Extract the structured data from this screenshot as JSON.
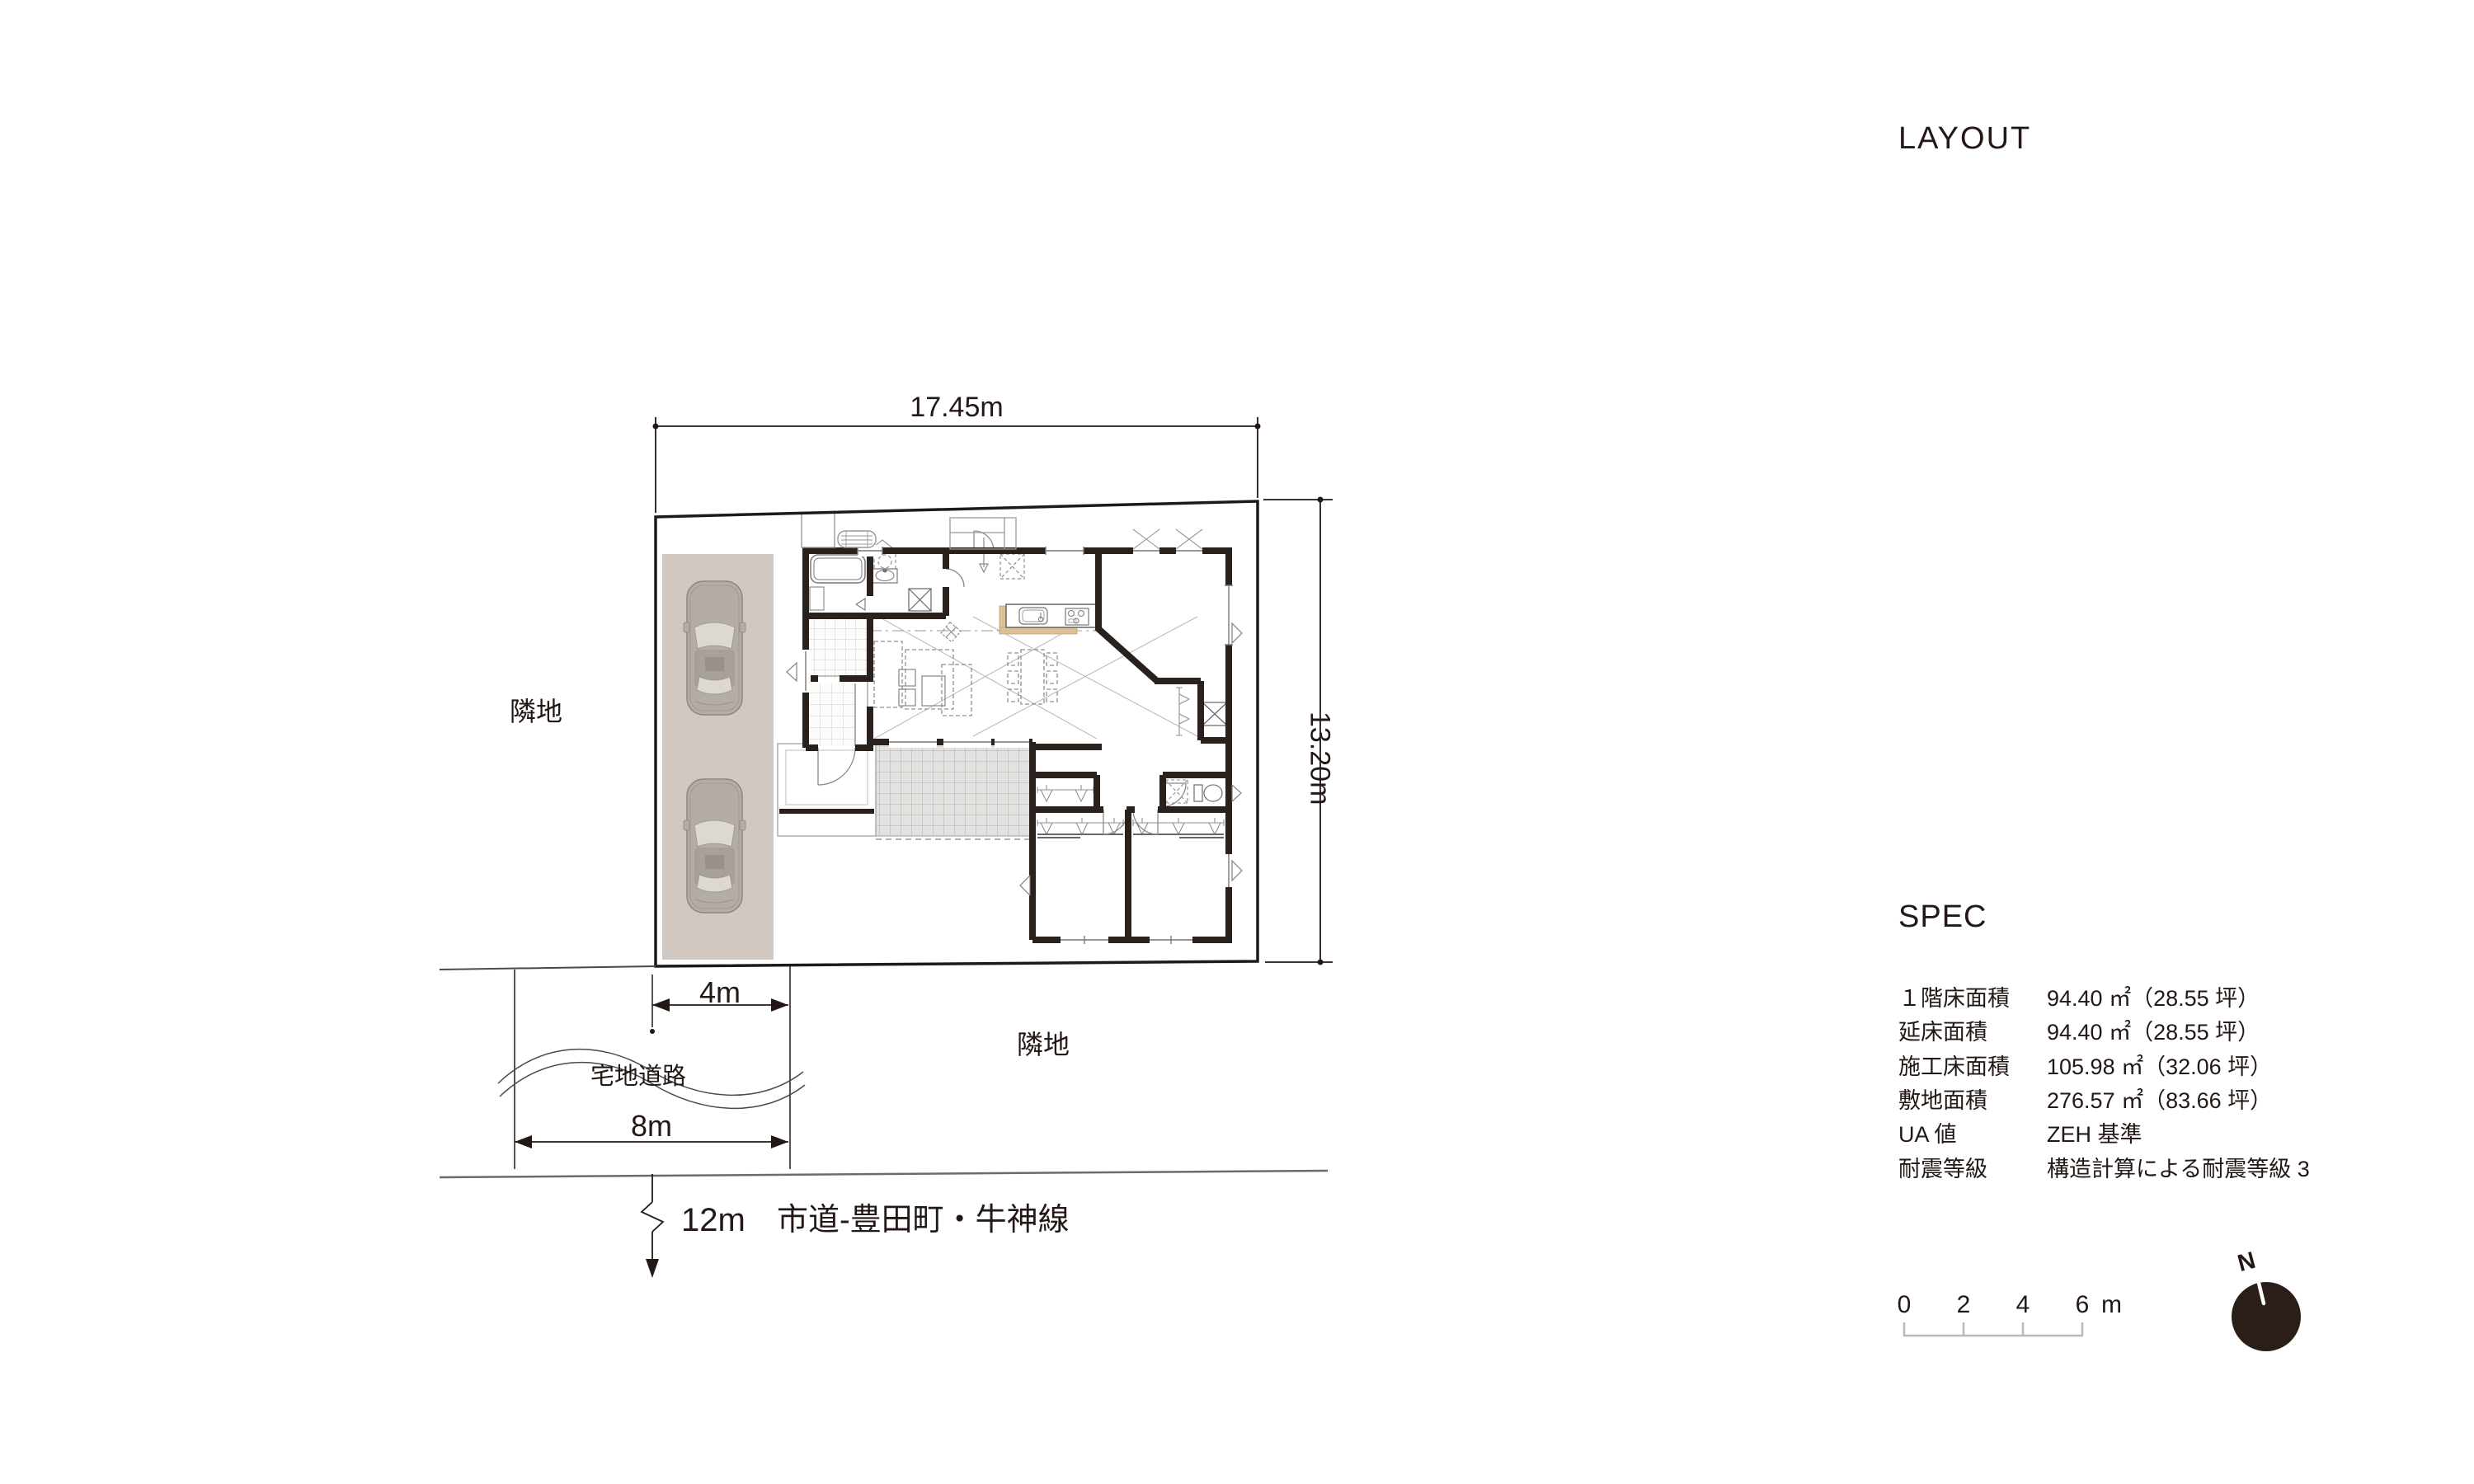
{
  "title": "LAYOUT",
  "spec": {
    "heading": "SPEC",
    "rows": [
      {
        "label": "１階床面積",
        "value": "94.40 ㎡（28.55 坪）"
      },
      {
        "label": "延床面積",
        "value": "94.40 ㎡（28.55 坪）"
      },
      {
        "label": "施工床面積",
        "value": "105.98 ㎡（32.06 坪）"
      },
      {
        "label": "敷地面積",
        "value": "276.57 ㎡（83.66 坪）"
      },
      {
        "label": "UA 値",
        "value": "ZEH 基準"
      },
      {
        "label": "耐震等級",
        "value": "構造計算による耐震等級 3"
      }
    ]
  },
  "site": {
    "dimensions": {
      "width": "17.45m",
      "depth": "13.20m",
      "parking_entrance": "4m",
      "frontage": "8m",
      "road_width": "12m"
    },
    "labels": {
      "adjacent_left": "隣地",
      "adjacent_right": "隣地",
      "residential_road": "宅地道路",
      "road_name": "市道-豊田町・牛神線"
    }
  },
  "scalebar": {
    "ticks": [
      "0",
      "2",
      "4",
      "6"
    ],
    "unit": "m"
  },
  "compass": {
    "north_label": "N"
  },
  "colors": {
    "ink": "#231815",
    "wall": "#2a211d",
    "parking_fill": "#d2c8c2",
    "deck_fill": "#e3e2e0",
    "counter_accent": "#ddc096",
    "compass_fill": "#2b1d17"
  }
}
